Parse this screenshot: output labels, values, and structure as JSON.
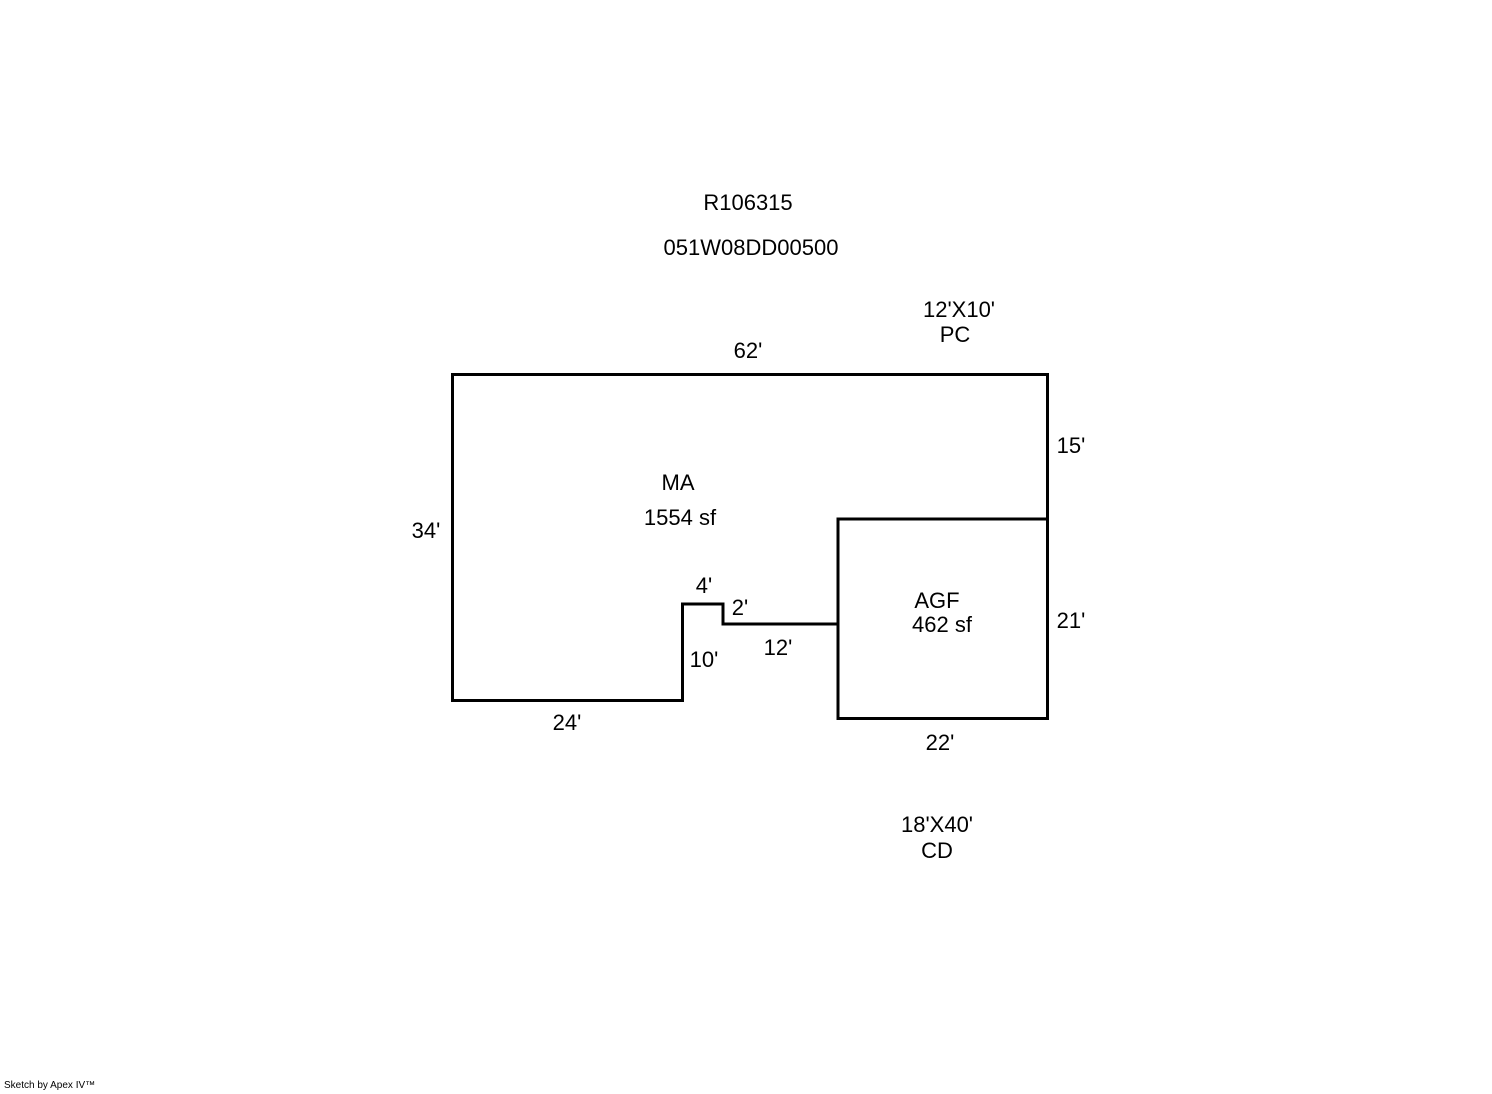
{
  "header": {
    "record_id": "R106315",
    "parcel_id": "051W08DD00500"
  },
  "main_area": {
    "code": "MA",
    "area": "1554 sf",
    "dim_top": "62'",
    "dim_right": "15'",
    "dim_left": "34'",
    "dim_bottom": "24'",
    "dim_notch_top": "4'",
    "dim_notch_side": "2'",
    "dim_notch_height": "10'",
    "dim_inner_bottom": "12'"
  },
  "garage": {
    "code": "AGF",
    "area": "462 sf",
    "dim_right": "21'",
    "dim_bottom": "22'"
  },
  "annotations": {
    "pc": {
      "size": "12'X10'",
      "code": "PC"
    },
    "cd": {
      "size": "18'X40'",
      "code": "CD"
    }
  },
  "footer": {
    "watermark": "Sketch by Apex IV™"
  },
  "colors": {
    "line": "#000000",
    "text": "#000000",
    "background": "#ffffff"
  }
}
